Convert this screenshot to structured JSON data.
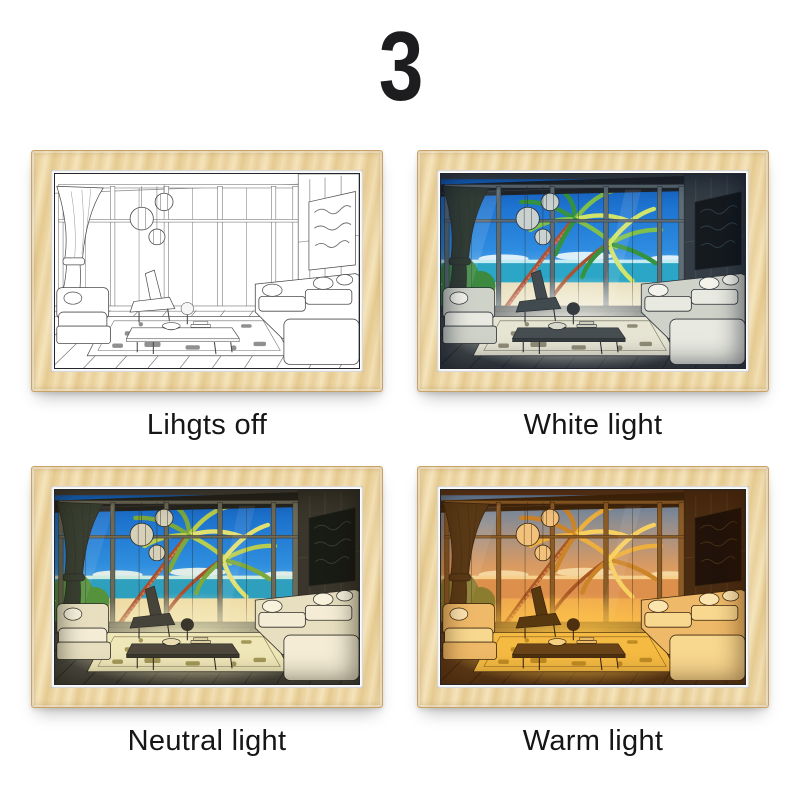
{
  "page_number": "3",
  "frame": {
    "wood_color": "#eccf9b",
    "mat_color": "#ffffff"
  },
  "grid": {
    "items": [
      {
        "label": "Lihgts off",
        "mode": "off",
        "glow_color": "none"
      },
      {
        "label": "White light",
        "mode": "white",
        "glow_color": "#f8f8f0"
      },
      {
        "label": "Neutral light",
        "mode": "neutral",
        "glow_color": "#f6eec0"
      },
      {
        "label": "Warm light",
        "mode": "warm",
        "glow_color": "#ffc648"
      }
    ]
  }
}
